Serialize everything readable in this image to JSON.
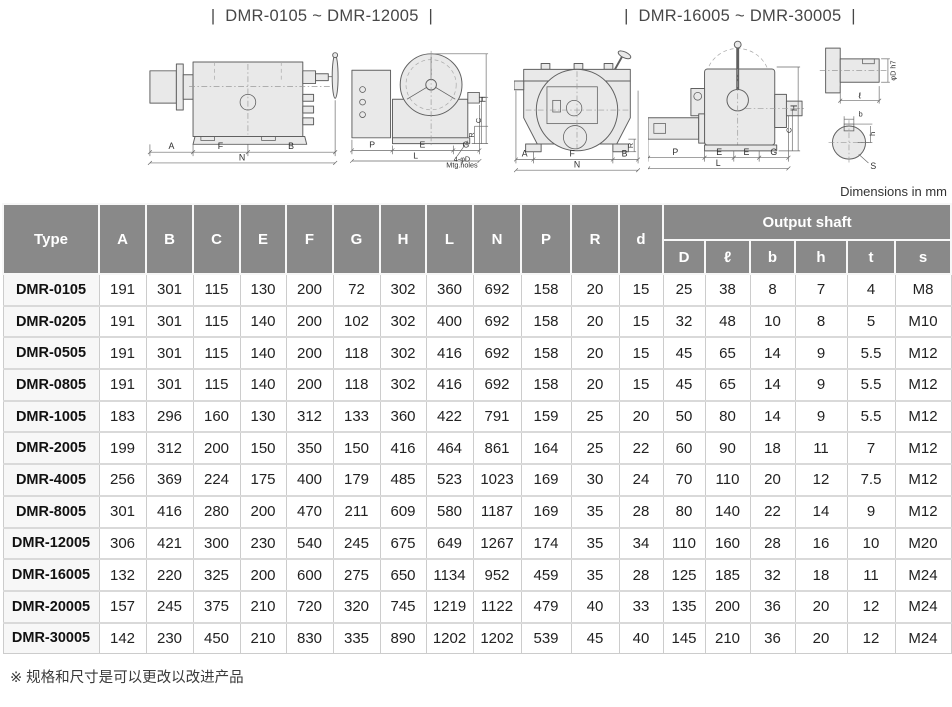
{
  "page": {
    "dimensions_note": "Dimensions in mm",
    "footnote": "※ 规格和尺寸是可以更改以改进产品"
  },
  "colors": {
    "header_bg": "#898989",
    "header_text": "#ffffff",
    "type_column_bg": "#f7f7f7",
    "grid_line": "#cccccc",
    "body_text": "#222222"
  },
  "diagrams": {
    "left": {
      "title": "|  DMR-0105 ~ DMR-12005  |",
      "side_view": {
        "dims": [
          "A",
          "F",
          "B",
          "N"
        ]
      },
      "front_view": {
        "dims_bottom": [
          "P",
          "E",
          "G",
          "L"
        ],
        "dims_right": [
          "H",
          "C",
          "R"
        ],
        "mtg_line1": "4-φD",
        "mtg_line2": "Mtg.holes"
      }
    },
    "right": {
      "title": "|  DMR-16005 ~ DMR-30005  |",
      "front_view": {
        "dims": [
          "A",
          "F",
          "B",
          "N"
        ],
        "dims_right": [
          "R"
        ]
      },
      "side_view": {
        "dims_bottom": [
          "P",
          "E",
          "E",
          "G",
          "L"
        ],
        "dims_right": [
          "H",
          "C"
        ]
      },
      "shaft_detail": {
        "labels": [
          "φD h7",
          "ℓ",
          "b",
          "h",
          "S"
        ]
      }
    }
  },
  "table": {
    "header": {
      "type": "Type",
      "columns": [
        "A",
        "B",
        "C",
        "E",
        "F",
        "G",
        "H",
        "L",
        "N",
        "P",
        "R",
        "d"
      ],
      "output_shaft": "Output shaft",
      "output_shaft_columns": [
        "D",
        "ℓ",
        "b",
        "h",
        "t",
        "s"
      ]
    },
    "rows": [
      {
        "type": "DMR-0105",
        "values": [
          191,
          301,
          115,
          130,
          200,
          72,
          302,
          360,
          692,
          158,
          20,
          15,
          25,
          38,
          8,
          7,
          4,
          "M8"
        ]
      },
      {
        "type": "DMR-0205",
        "values": [
          191,
          301,
          115,
          140,
          200,
          102,
          302,
          400,
          692,
          158,
          20,
          15,
          32,
          48,
          10,
          8,
          5,
          "M10"
        ]
      },
      {
        "type": "DMR-0505",
        "values": [
          191,
          301,
          115,
          140,
          200,
          118,
          302,
          416,
          692,
          158,
          20,
          15,
          45,
          65,
          14,
          9,
          5.5,
          "M12"
        ]
      },
      {
        "type": "DMR-0805",
        "values": [
          191,
          301,
          115,
          140,
          200,
          118,
          302,
          416,
          692,
          158,
          20,
          15,
          45,
          65,
          14,
          9,
          5.5,
          "M12"
        ]
      },
      {
        "type": "DMR-1005",
        "values": [
          183,
          296,
          160,
          130,
          312,
          133,
          360,
          422,
          791,
          159,
          25,
          20,
          50,
          80,
          14,
          9,
          5.5,
          "M12"
        ]
      },
      {
        "type": "DMR-2005",
        "values": [
          199,
          312,
          200,
          150,
          350,
          150,
          416,
          464,
          861,
          164,
          25,
          22,
          60,
          90,
          18,
          11,
          7,
          "M12"
        ]
      },
      {
        "type": "DMR-4005",
        "values": [
          256,
          369,
          224,
          175,
          400,
          179,
          485,
          523,
          1023,
          169,
          30,
          24,
          70,
          110,
          20,
          12,
          7.5,
          "M12"
        ]
      },
      {
        "type": "DMR-8005",
        "values": [
          301,
          416,
          280,
          200,
          470,
          211,
          609,
          580,
          1187,
          169,
          35,
          28,
          80,
          140,
          22,
          14,
          9,
          "M12"
        ]
      },
      {
        "type": "DMR-12005",
        "values": [
          306,
          421,
          300,
          230,
          540,
          245,
          675,
          649,
          1267,
          174,
          35,
          34,
          110,
          160,
          28,
          16,
          10,
          "M20"
        ]
      },
      {
        "type": "DMR-16005",
        "values": [
          132,
          220,
          325,
          200,
          600,
          275,
          650,
          1134,
          952,
          459,
          35,
          28,
          125,
          185,
          32,
          18,
          11,
          "M24"
        ]
      },
      {
        "type": "DMR-20005",
        "values": [
          157,
          245,
          375,
          210,
          720,
          320,
          745,
          1219,
          1122,
          479,
          40,
          33,
          135,
          200,
          36,
          20,
          12,
          "M24"
        ]
      },
      {
        "type": "DMR-30005",
        "values": [
          142,
          230,
          450,
          210,
          830,
          335,
          890,
          1202,
          1202,
          539,
          45,
          40,
          145,
          210,
          36,
          20,
          12,
          "M24"
        ]
      }
    ]
  }
}
